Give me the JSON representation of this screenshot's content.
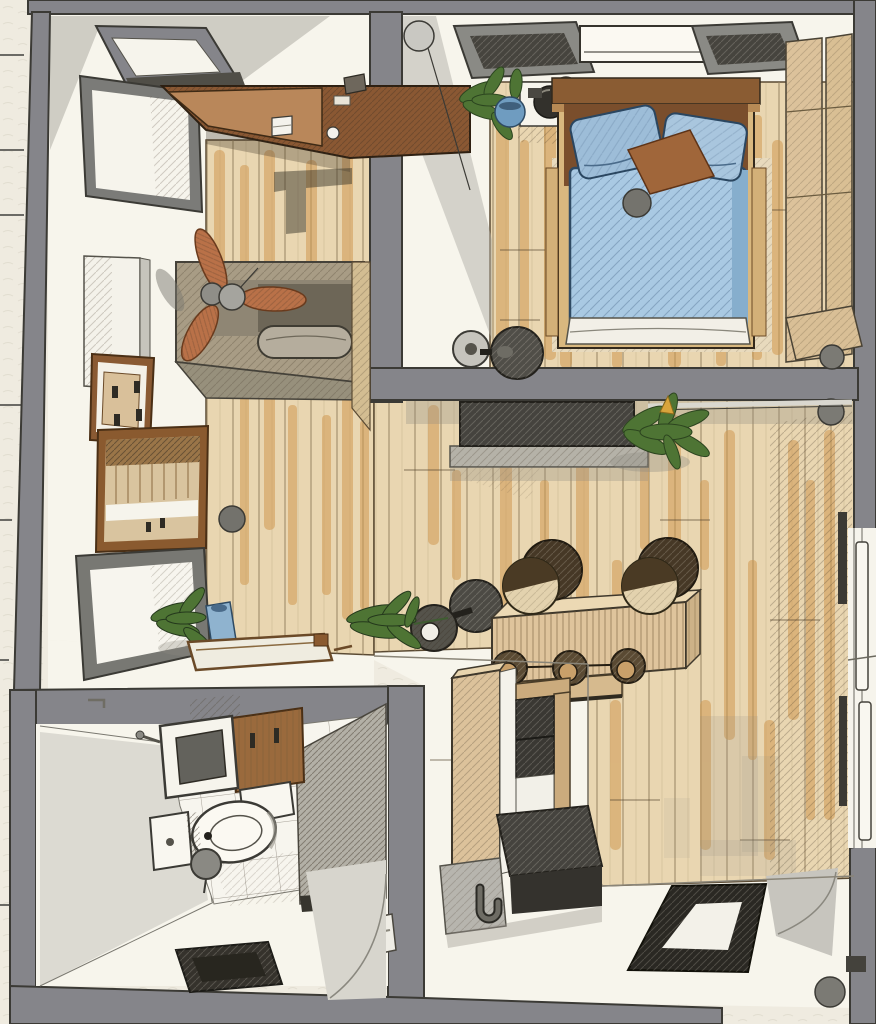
{
  "meta": {
    "title": "Hand-drawn apartment floor plan, top-down sketch view",
    "style": "watercolor / ink architectural illustration",
    "canvas": {
      "width": 876,
      "height": 1024
    }
  },
  "palette": {
    "paper": "#efebe0",
    "room_white": "#f7f5ec",
    "wall_gray": "#85858a",
    "wall_outline": "#3b3a35",
    "wood_floor": "#e9d6b1",
    "wood_streak": "#d09a52",
    "dark_wood": "#8a5833",
    "desk_face": "#b9875a",
    "fan_blade": "#b97148",
    "bench_taupe": "#a89c85",
    "cushion_gray": "#b5ad9d",
    "bed_blue": "#a9c9e3",
    "bed_blue_fold": "#86aecd",
    "pillow_blue": "#9dbdd8",
    "pillow_brown": "#a0663a",
    "sheet_white": "#f2efe7",
    "plant_green": "#4e7434",
    "counter_tan": "#dfc49c",
    "stool_wood": "#c9a06a",
    "stool_dark": "#5a4a33",
    "slab_dark": "#45433e",
    "frame_black": "#2a2823",
    "light_gray": "#d7d5cd",
    "mid_gray": "#b2b0a8",
    "steel_gray": "#8a8983",
    "glass_blue": "#8fb3cf",
    "cabinet_tan": "#dcc29b"
  },
  "scene": {
    "view": "top-down",
    "rooms": [
      {
        "name": "bedroom",
        "objects": [
          "double bed with blue duvet",
          "two blue pillows",
          "brown cushion",
          "wood headboard",
          "nightstand with round speaker",
          "potted plant",
          "two dark skylights",
          "air conditioner",
          "wardrobe panels",
          "corner pulley dot"
        ]
      },
      {
        "name": "studio-corner",
        "objects": [
          "desk with laptop and cup",
          "ceiling fan",
          "daybed with long cushion",
          "leaning whiteboard",
          "light skylight",
          "wall cabinet",
          "electrical panel",
          "wood framed mirror",
          "gray floor mirror",
          "plant in blue vase",
          "wooden floor tray"
        ]
      },
      {
        "name": "living-area",
        "objects": [
          "media console",
          "weight plates",
          "bar counter",
          "two barrel stools",
          "three round stools",
          "potted plants",
          "black floor frame",
          "sliding glass door",
          "column dots"
        ]
      },
      {
        "name": "kitchen",
        "objects": [
          "tall pantry cabinet",
          "open shelf with dark bay",
          "dark island counter",
          "hanging hook"
        ]
      },
      {
        "name": "bathroom",
        "objects": [
          "vanity sink",
          "wood wall cabinet",
          "toilet",
          "paper holder",
          "floor bin",
          "dark drain mat",
          "hatched shower partition",
          "towel rail",
          "tiled floor"
        ]
      }
    ]
  }
}
